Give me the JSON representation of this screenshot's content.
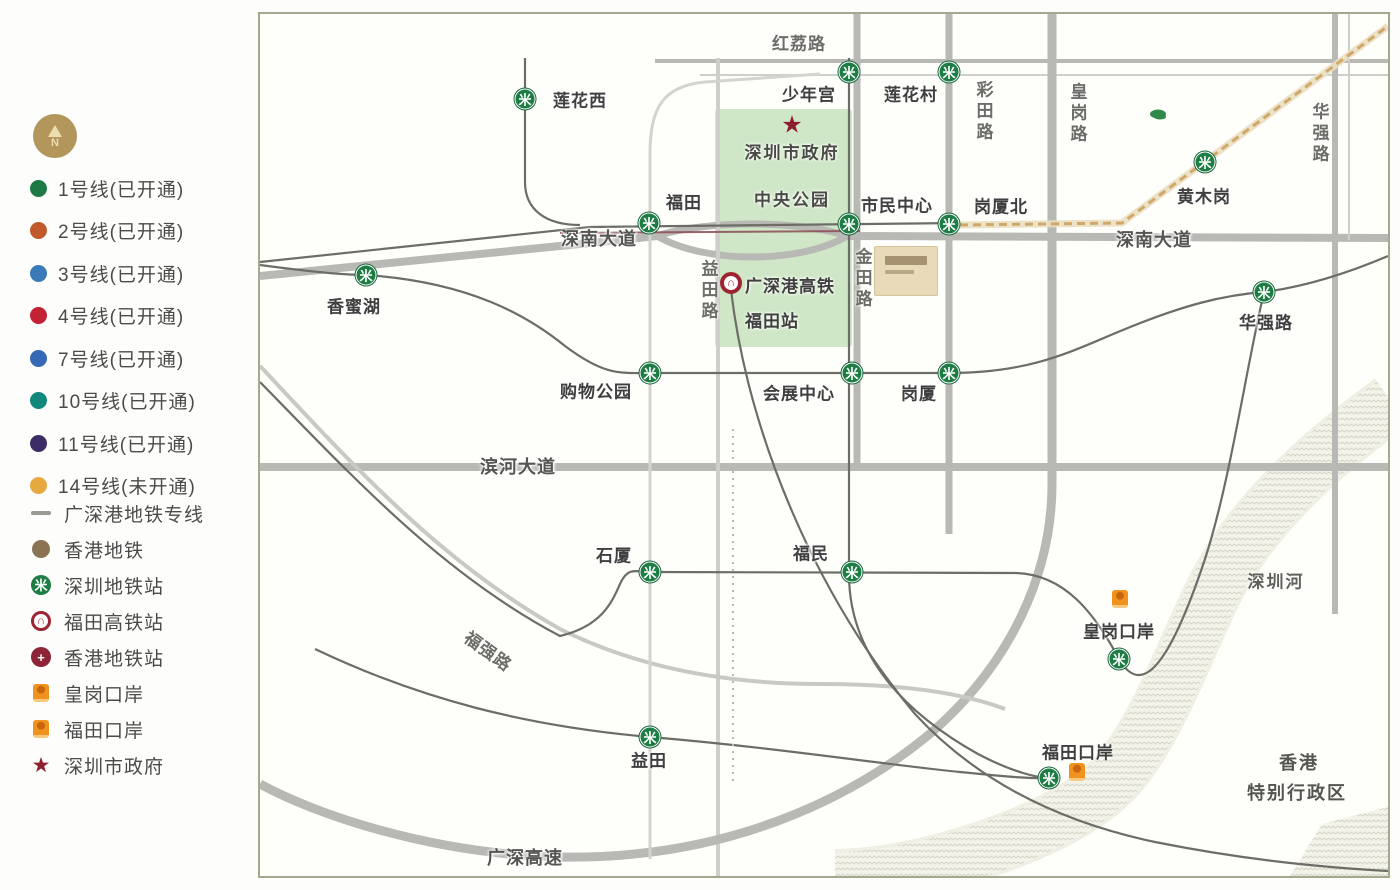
{
  "compass": {
    "letter": "N"
  },
  "legend": {
    "lines": [
      {
        "label": "1号线(已开通)",
        "color": "#1e7a45"
      },
      {
        "label": "2号线(已开通)",
        "color": "#c05a2a"
      },
      {
        "label": "3号线(已开通)",
        "color": "#3a7ab8"
      },
      {
        "label": "4号线(已开通)",
        "color": "#c22234"
      },
      {
        "label": "7号线(已开通)",
        "color": "#3668b8"
      },
      {
        "label": "10号线(已开通)",
        "color": "#10897c"
      },
      {
        "label": "11号线(已开通)",
        "color": "#3b2d66"
      },
      {
        "label": "14号线(未开通)",
        "color": "#e8a840"
      }
    ],
    "symbols": [
      {
        "label": "广深港地铁专线",
        "icon": "rail-line-sample-icon"
      },
      {
        "label": "香港地铁",
        "icon": "hk-line-dot-icon"
      },
      {
        "label": "深圳地铁站",
        "icon": "shenzhen-metro-station-icon"
      },
      {
        "label": "福田高铁站",
        "icon": "hsr-station-icon"
      },
      {
        "label": "香港地铁站",
        "icon": "hk-metro-station-icon"
      },
      {
        "label": "皇岗口岸",
        "icon": "port-icon"
      },
      {
        "label": "福田口岸",
        "icon": "port-icon"
      },
      {
        "label": "深圳市政府",
        "icon": "government-star-icon"
      }
    ]
  },
  "map": {
    "stations": [
      {
        "name": "莲花西",
        "x": 265,
        "y": 85,
        "lx": 320,
        "ly": 85
      },
      {
        "name": "少年宫",
        "x": 589,
        "y": 58,
        "lx": 549,
        "ly": 79
      },
      {
        "name": "莲花村",
        "x": 689,
        "y": 58,
        "lx": 651,
        "ly": 79
      },
      {
        "name": "黄木岗",
        "x": 945,
        "y": 148,
        "lx": 944,
        "ly": 181
      },
      {
        "name": "福田",
        "x": 389,
        "y": 209,
        "lx": 424,
        "ly": 187
      },
      {
        "name": "市民中心",
        "x": 589,
        "y": 210,
        "lx": 637,
        "ly": 190
      },
      {
        "name": "岗厦北",
        "x": 689,
        "y": 210,
        "lx": 741,
        "ly": 191
      },
      {
        "name": "香蜜湖",
        "x": 106,
        "y": 261,
        "lx": 94,
        "ly": 291
      },
      {
        "name": "华强路",
        "x": 1004,
        "y": 278,
        "lx": 1006,
        "ly": 307
      },
      {
        "name": "购物公园",
        "x": 390,
        "y": 359,
        "lx": 336,
        "ly": 376
      },
      {
        "name": "会展中心",
        "x": 592,
        "y": 359,
        "lx": 539,
        "ly": 378
      },
      {
        "name": "岗厦",
        "x": 689,
        "y": 359,
        "lx": 659,
        "ly": 378
      },
      {
        "name": "石厦",
        "x": 390,
        "y": 558,
        "lx": 354,
        "ly": 540
      },
      {
        "name": "福民",
        "x": 592,
        "y": 558,
        "lx": 551,
        "ly": 538
      },
      {
        "name": "益田",
        "x": 390,
        "y": 723,
        "lx": 389,
        "ly": 745
      },
      {
        "name": "",
        "x": 859,
        "y": 645
      },
      {
        "name": "",
        "x": 789,
        "y": 764
      }
    ],
    "hsr_station": {
      "line1": "广深港高铁",
      "line2": "福田站",
      "ix": 471,
      "iy": 269,
      "tx": 485,
      "ty": 255
    },
    "ports": [
      {
        "name": "皇岗口岸",
        "ex": 860,
        "ey": 585,
        "lx": 859,
        "ly": 616
      },
      {
        "name": "福田口岸",
        "ex": 817,
        "ey": 758,
        "lx": 818,
        "ly": 737
      }
    ],
    "road_labels": [
      {
        "t": "红荔路",
        "x": 539,
        "y": 28
      },
      {
        "t": "深南大道",
        "x": 339,
        "y": 224,
        "halo": true
      },
      {
        "t": "深南大道",
        "x": 894,
        "y": 225,
        "halo": true
      },
      {
        "t": "滨河大道",
        "x": 258,
        "y": 452,
        "halo": true
      },
      {
        "t": "广深高速",
        "x": 265,
        "y": 843,
        "halo": true
      },
      {
        "t": "福强路",
        "x": 229,
        "y": 636,
        "rot": 36
      },
      {
        "t": "益田路",
        "x": 448,
        "y": 277,
        "v": true
      },
      {
        "t": "金田路",
        "x": 602,
        "y": 265,
        "v": true
      },
      {
        "t": "彩田路",
        "x": 723,
        "y": 98,
        "v": true
      },
      {
        "t": "皇岗路",
        "x": 817,
        "y": 100,
        "v": true
      },
      {
        "t": "华强路",
        "x": 1059,
        "y": 120,
        "v": true
      }
    ],
    "area_labels": [
      {
        "t": "深圳市政府",
        "x": 532,
        "y": 137
      },
      {
        "t": "中央公园",
        "x": 532,
        "y": 184
      },
      {
        "t": "深圳河",
        "x": 1016,
        "y": 566,
        "cls": "river"
      },
      {
        "t": "香港",
        "x": 1039,
        "y": 748,
        "cls": "hk"
      },
      {
        "t": "特别行政区",
        "x": 1037,
        "y": 778,
        "cls": "hk"
      }
    ],
    "gov_star": {
      "x": 532,
      "y": 111
    }
  },
  "colors": {
    "metro_green": "#1e7c45",
    "hsr_red": "#9e2433",
    "port_orange": "#f0921e",
    "star_red": "#8e1f2f",
    "line14_tan": "#cfa86a",
    "road_gray": "#b8b8b4",
    "park_green": "#cfe7c6"
  }
}
